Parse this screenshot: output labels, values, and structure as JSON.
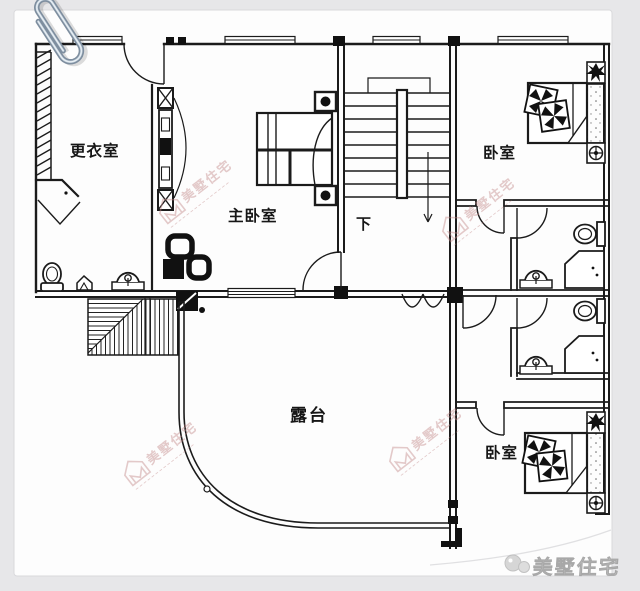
{
  "canvas": {
    "background": "#e7e7e9",
    "sheet": "#fdfdfd",
    "ink": "#1b1b1b"
  },
  "labels": {
    "dressing_room": "更衣室",
    "master_bedroom": "主卧室",
    "bedroom_top": "卧室",
    "bedroom_bottom": "卧室",
    "terrace": "露台",
    "stairs_down": "下"
  },
  "watermark": {
    "text": "美墅住宅",
    "color": "#c28a8a"
  },
  "brand": {
    "text": "美墅住宅",
    "color": "#c8c8c8"
  },
  "icons": {
    "paperclip": "paperclip-icon",
    "toilet": "toilet-icon",
    "sink": "sink-icon",
    "shower": "shower-icon",
    "bed": "bed-icon",
    "pillow": "pinwheel-pillow-icon",
    "plant": "plant-icon",
    "lamp": "lamp-icon",
    "wardrobe": "wardrobe-hatch-icon",
    "stairs": "stairs-icon",
    "watermark_logo": "house-logo-icon",
    "brand_logo": "brand-logo-icon"
  }
}
